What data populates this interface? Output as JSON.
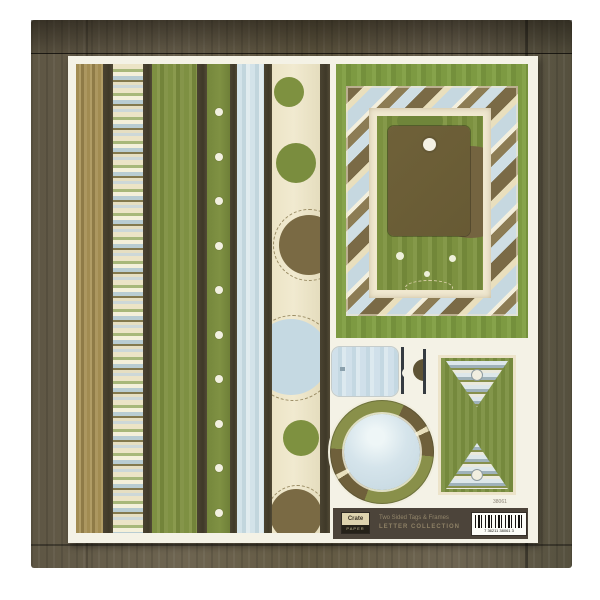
{
  "product": {
    "brand": "Crate",
    "brand_sub": "PAPER",
    "desc_line1": "Two Sided Tags & Frames",
    "desc_line2": "LETTER COLLECTION",
    "item_number": "38061",
    "barcode_text": "7 36211 38061 3"
  },
  "palette": {
    "wood_brown": "#6a614d",
    "dark_stripe": "#46402e",
    "olive_green": "#7e9042",
    "tan": "#a28c52",
    "cream": "#ece4c6",
    "light_blue": "#d3e3e9",
    "tag_brown": "#6f6139",
    "label_strip": "#4c443a",
    "sheet_white": "#f4f2e6"
  }
}
